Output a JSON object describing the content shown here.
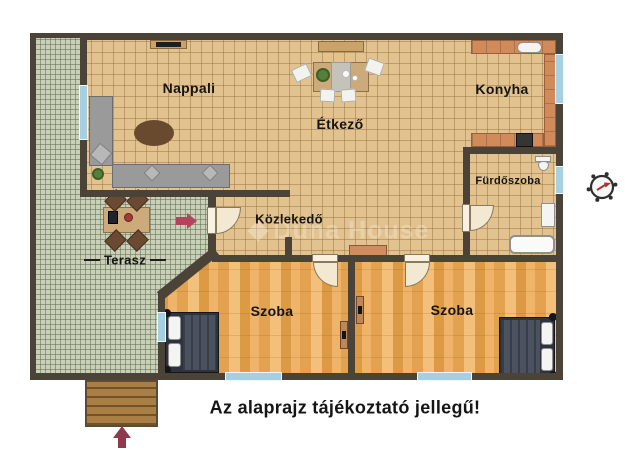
{
  "plan": {
    "disclaimer": "Az alaprajz tájékoztató jellegű!",
    "watermark": "Duna House",
    "rooms": {
      "nappali": {
        "label": "Nappali"
      },
      "etkezo": {
        "label": "Étkező"
      },
      "konyha": {
        "label": "Konyha"
      },
      "furdoszoba": {
        "label": "Fürdőszoba"
      },
      "kozlekedo": {
        "label": "Közlekedő"
      },
      "terasz": {
        "label": "Terasz"
      },
      "szoba1": {
        "label": "Szoba"
      },
      "szoba2": {
        "label": "Szoba"
      }
    },
    "colors": {
      "wall": "#4b4238",
      "tile_floor": "#e2c38f",
      "terrace_floor": "#c9d0b8",
      "wood_floor": "#e8ad5d",
      "counter": "#d18b5b",
      "window": "#a6d0e2",
      "entry_arrow": "#b2455c",
      "compass_needle": "#b03030"
    },
    "icons": {
      "compass": "compass-rose",
      "terrace_arrow": "entrance-arrow-right",
      "street_arrow": "entrance-arrow-up"
    }
  }
}
